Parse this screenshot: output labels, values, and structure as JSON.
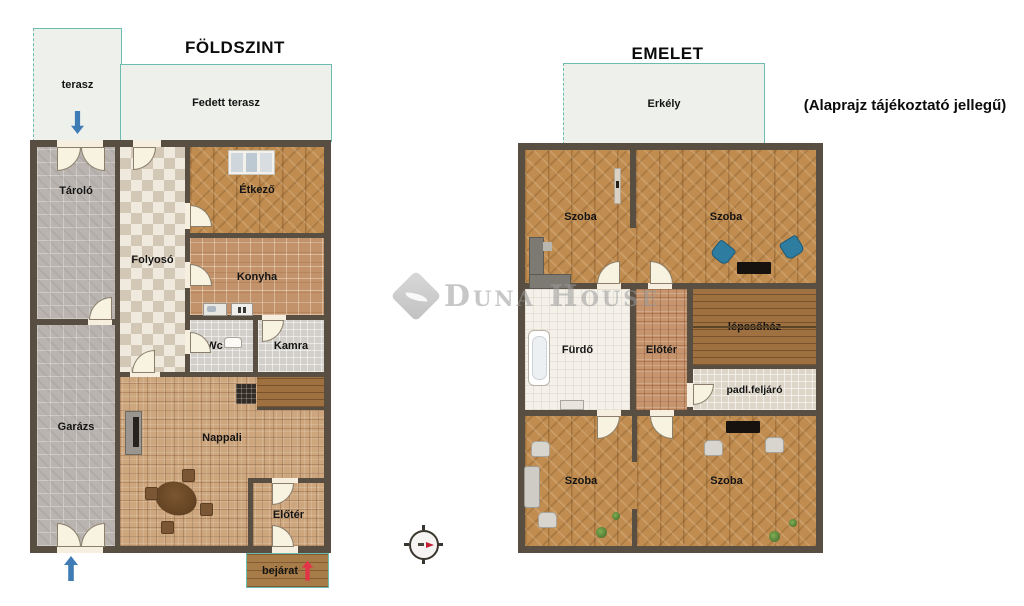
{
  "watermark": {
    "brand": "Duna House"
  },
  "disclaimer": "(Alaprajz tájékoztató jellegű)",
  "ground": {
    "title": "FÖLDSZINT",
    "terrace": "terasz",
    "covered_terrace": "Fedett terasz",
    "entrance": "bejárat",
    "rooms": {
      "tarolo": "Tároló",
      "folyoso": "Folyosó",
      "etkezo": "Étkező",
      "konyha": "Konyha",
      "wc": "Wc",
      "kamra": "Kamra",
      "garazs": "Garázs",
      "nappali": "Nappali",
      "eloter": "Előtér"
    }
  },
  "upper": {
    "title": "EMELET",
    "balcony": "Erkély",
    "rooms": {
      "szoba_tl": "Szoba",
      "szoba_tr": "Szoba",
      "furdo": "Fürdő",
      "eloter": "Előtér",
      "lepcsohaz": "lépcsőház",
      "padl_feljaro": "padl.feljáró",
      "szoba_bl": "Szoba",
      "szoba_br": "Szoba"
    }
  },
  "icons": {
    "terrace_arrow": "blue-down-arrow",
    "garage_arrow": "blue-up-arrow",
    "entrance_arrow": "red-up-arrow",
    "compass": "compass-rose",
    "logo": "duna-house-diamond-leaf"
  },
  "colors": {
    "wall": "#584e41",
    "terrace_fill": "#eef0ec",
    "terrace_border": "#6cbdb0",
    "wood_floor": "#c08c4f",
    "warm_tile": "#cda67e",
    "accent_blue": "#3f7cb6",
    "accent_red": "#e23347",
    "watermark_gray": "#9a9a9a"
  }
}
